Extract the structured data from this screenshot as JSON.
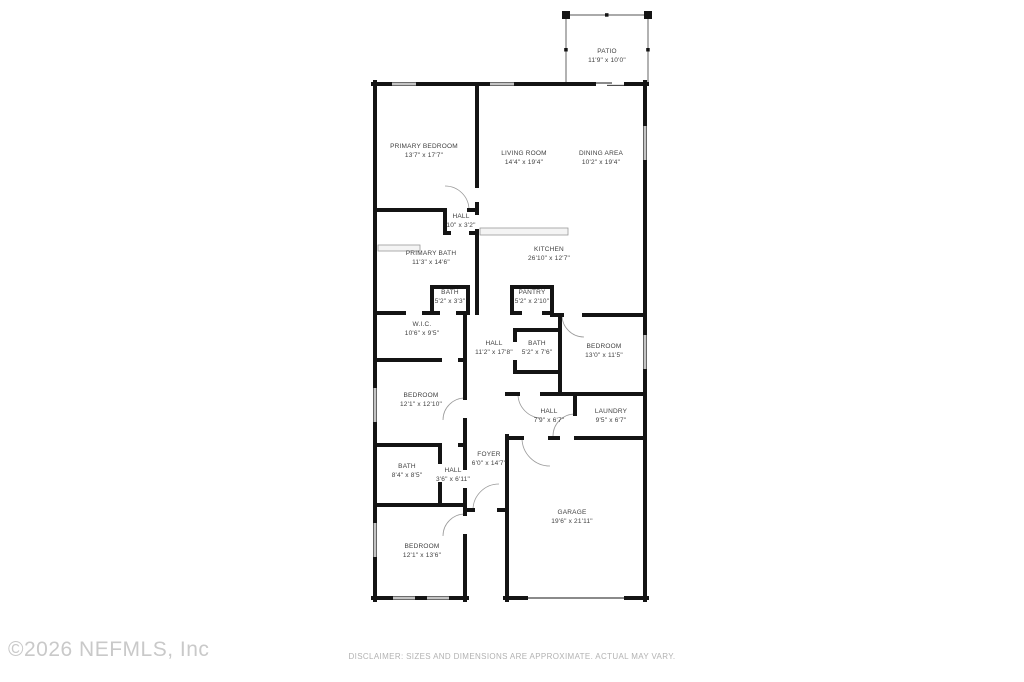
{
  "colors": {
    "walls": "#141414",
    "thin_lines": "#141414",
    "door_arcs": "#999999",
    "counter_fill": "#f4f4f4",
    "label_text": "#3f3f3f",
    "watermark": "#c9c9c9",
    "disclaimer_text": "#b2b2b2"
  },
  "floorplan": {
    "rooms": [
      {
        "name": "PATIO",
        "dims": "11'9\" x 10'0\""
      },
      {
        "name": "PRIMARY BEDROOM",
        "dims": "13'7\" x 17'7\""
      },
      {
        "name": "LIVING ROOM",
        "dims": "14'4\" x 19'4\""
      },
      {
        "name": "DINING AREA",
        "dims": "10'2\" x 19'4\""
      },
      {
        "name": "HALL",
        "dims": "10\" x 3'2\""
      },
      {
        "name": "PRIMARY BATH",
        "dims": "11'3\" x 14'6\""
      },
      {
        "name": "KITCHEN",
        "dims": "26'10\" x 12'7\""
      },
      {
        "name": "BATH",
        "dims": "5'2\" x 3'3\""
      },
      {
        "name": "PANTRY",
        "dims": "5'2\" x 2'10\""
      },
      {
        "name": "W.I.C.",
        "dims": "10'6\" x 9'5\""
      },
      {
        "name": "HALL",
        "dims": "11'2\" x 17'8\""
      },
      {
        "name": "BATH",
        "dims": "5'2\" x 7'6\""
      },
      {
        "name": "BEDROOM",
        "dims": "13'0\" x 11'5\""
      },
      {
        "name": "BEDROOM",
        "dims": "12'1\" x 12'10\""
      },
      {
        "name": "HALL",
        "dims": "7'9\" x 6'7\""
      },
      {
        "name": "LAUNDRY",
        "dims": "9'5\" x 6'7\""
      },
      {
        "name": "FOYER",
        "dims": "6'0\" x 14'7\""
      },
      {
        "name": "BATH",
        "dims": "8'4\" x 8'5\""
      },
      {
        "name": "HALL",
        "dims": "3'6\" x 6'11\""
      },
      {
        "name": "GARAGE",
        "dims": "19'6\" x 21'11\""
      },
      {
        "name": "BEDROOM",
        "dims": "12'1\" x 13'6\""
      }
    ]
  },
  "footer": {
    "copyright": "©2026 NEFMLS, Inc",
    "disclaimer": "DISCLAIMER: SIZES AND DIMENSIONS ARE APPROXIMATE. ACTUAL MAY VARY."
  }
}
